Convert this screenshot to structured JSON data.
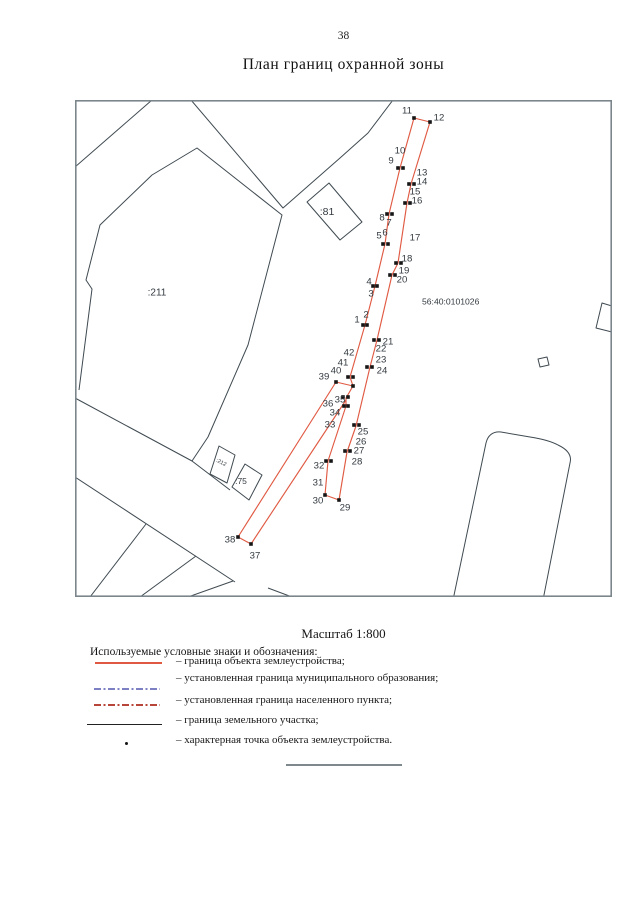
{
  "page": {
    "number": "38",
    "title": "План границ охранной зоны",
    "scale_label": "Масштаб 1:800"
  },
  "colors": {
    "object_boundary": "#e05a43",
    "municipal_boundary": "#7d81c3",
    "settlement_boundary": "#b8453a",
    "parcel_line": "#3f4a51",
    "frame": "#7b868c",
    "point_dot": "#161616",
    "map_text": "#333a40"
  },
  "map": {
    "frame": [
      75,
      100,
      537,
      497
    ],
    "quarter_label": {
      "text": "56:40:0101026",
      "x": 422,
      "y": 298
    },
    "parcel_labels": [
      {
        "text": ":211",
        "x": 157,
        "y": 293,
        "size": 10
      },
      {
        "text": ":81",
        "x": 327,
        "y": 212,
        "size": 10.5
      },
      {
        "text": ":75",
        "x": 241,
        "y": 481,
        "size": 8.5
      },
      {
        "text": ":212",
        "x": 221,
        "y": 463,
        "size": 5.5,
        "rotate": 27
      }
    ],
    "black_polylines": [
      [
        [
          152,
          100
        ],
        [
          75,
          167
        ]
      ],
      [
        [
          191,
          100
        ],
        [
          283,
          208
        ],
        [
          340,
          158
        ],
        [
          368,
          133
        ],
        [
          393,
          100
        ]
      ],
      [
        [
          79,
          390
        ],
        [
          92,
          289
        ],
        [
          86,
          280
        ],
        [
          100,
          225
        ],
        [
          152,
          175
        ],
        [
          197,
          148
        ],
        [
          282,
          215
        ],
        [
          248,
          345
        ],
        [
          208,
          437
        ],
        [
          192,
          461
        ]
      ],
      [
        [
          75,
          398
        ],
        [
          192,
          461
        ],
        [
          230,
          490
        ]
      ],
      [
        [
          75,
          477
        ],
        [
          235,
          582
        ]
      ],
      [
        [
          90,
          597
        ],
        [
          146,
          524
        ]
      ],
      [
        [
          140,
          597
        ],
        [
          196,
          556
        ]
      ],
      [
        [
          188,
          597
        ],
        [
          233,
          581
        ]
      ],
      [
        [
          268,
          588
        ],
        [
          292,
          597
        ]
      ],
      [
        [
          612,
          306
        ],
        [
          602,
          303
        ],
        [
          596,
          328
        ],
        [
          612,
          332
        ]
      ]
    ],
    "black_polygons": [
      [
        [
          329,
          183
        ],
        [
          362,
          222
        ],
        [
          340,
          240
        ],
        [
          307,
          202
        ]
      ],
      [
        [
          219,
          446
        ],
        [
          235,
          455
        ],
        [
          227,
          483
        ],
        [
          210,
          474
        ]
      ],
      [
        [
          245,
          464
        ],
        [
          262,
          475
        ],
        [
          249,
          500
        ],
        [
          232,
          487
        ]
      ],
      [
        [
          538,
          359
        ],
        [
          547,
          357
        ],
        [
          549,
          365
        ],
        [
          540,
          367
        ]
      ]
    ],
    "rounded_shape_path": "M 453 600 L 486 443 Q 489 431 501 432 L 530 437 Q 549 440 558 445 Q 573 452 570 463 L 543 600",
    "red_polylines": [
      [
        [
          414,
          118
        ],
        [
          430,
          122
        ],
        [
          411,
          184
        ],
        [
          407,
          203
        ],
        [
          398,
          263
        ],
        [
          392,
          275
        ],
        [
          377,
          340
        ],
        [
          370,
          367
        ],
        [
          356,
          426
        ],
        [
          347,
          452
        ],
        [
          339,
          500
        ],
        [
          325,
          495
        ],
        [
          328,
          461
        ],
        [
          346,
          406
        ],
        [
          346,
          398
        ],
        [
          353,
          386
        ],
        [
          350,
          377
        ],
        [
          365,
          325
        ],
        [
          375,
          286
        ],
        [
          385,
          244
        ],
        [
          389,
          214
        ],
        [
          400,
          168
        ],
        [
          414,
          118
        ]
      ],
      [
        [
          353,
          386
        ],
        [
          336,
          382
        ],
        [
          238,
          537
        ],
        [
          251,
          544
        ],
        [
          346,
          400
        ]
      ]
    ],
    "dots": [
      [
        414,
        118
      ],
      [
        430,
        122
      ],
      [
        398,
        168
      ],
      [
        403,
        168
      ],
      [
        409,
        184
      ],
      [
        414,
        184
      ],
      [
        405,
        203
      ],
      [
        410,
        203
      ],
      [
        387,
        214
      ],
      [
        392,
        214
      ],
      [
        383,
        244
      ],
      [
        388,
        244
      ],
      [
        396,
        263
      ],
      [
        401,
        263
      ],
      [
        390,
        275
      ],
      [
        395,
        275
      ],
      [
        373,
        286
      ],
      [
        377,
        286
      ],
      [
        363,
        325
      ],
      [
        367,
        325
      ],
      [
        374,
        340
      ],
      [
        379,
        340
      ],
      [
        367,
        367
      ],
      [
        372,
        367
      ],
      [
        348,
        377
      ],
      [
        353,
        377
      ],
      [
        353,
        386
      ],
      [
        336,
        382
      ],
      [
        343,
        397
      ],
      [
        348,
        397
      ],
      [
        344,
        406
      ],
      [
        348,
        406
      ],
      [
        354,
        425
      ],
      [
        359,
        425
      ],
      [
        345,
        451
      ],
      [
        350,
        451
      ],
      [
        326,
        461
      ],
      [
        331,
        461
      ],
      [
        325,
        495
      ],
      [
        339,
        500
      ],
      [
        238,
        537
      ],
      [
        251,
        544
      ]
    ],
    "point_labels": [
      {
        "n": "11",
        "x": 407,
        "y": 111
      },
      {
        "n": "12",
        "x": 439,
        "y": 118
      },
      {
        "n": "10",
        "x": 400,
        "y": 151
      },
      {
        "n": "9",
        "x": 391,
        "y": 161
      },
      {
        "n": "13",
        "x": 422,
        "y": 173
      },
      {
        "n": "14",
        "x": 422,
        "y": 182
      },
      {
        "n": "15",
        "x": 415,
        "y": 192
      },
      {
        "n": "16",
        "x": 417,
        "y": 201
      },
      {
        "n": "8",
        "x": 382,
        "y": 218
      },
      {
        "n": "7",
        "x": 389,
        "y": 223
      },
      {
        "n": "5",
        "x": 379,
        "y": 236
      },
      {
        "n": "6",
        "x": 385,
        "y": 233
      },
      {
        "n": "17",
        "x": 415,
        "y": 238
      },
      {
        "n": "18",
        "x": 407,
        "y": 259
      },
      {
        "n": "19",
        "x": 404,
        "y": 271
      },
      {
        "n": "20",
        "x": 402,
        "y": 280
      },
      {
        "n": "4",
        "x": 369,
        "y": 282
      },
      {
        "n": "3",
        "x": 371,
        "y": 294
      },
      {
        "n": "1",
        "x": 357,
        "y": 320
      },
      {
        "n": "2",
        "x": 366,
        "y": 315
      },
      {
        "n": "21",
        "x": 388,
        "y": 342
      },
      {
        "n": "22",
        "x": 381,
        "y": 349
      },
      {
        "n": "23",
        "x": 381,
        "y": 360
      },
      {
        "n": "24",
        "x": 382,
        "y": 371
      },
      {
        "n": "42",
        "x": 349,
        "y": 353
      },
      {
        "n": "41",
        "x": 343,
        "y": 363
      },
      {
        "n": "40",
        "x": 336,
        "y": 371
      },
      {
        "n": "39",
        "x": 324,
        "y": 377
      },
      {
        "n": "36",
        "x": 328,
        "y": 404
      },
      {
        "n": "35",
        "x": 340,
        "y": 400
      },
      {
        "n": "34",
        "x": 335,
        "y": 413
      },
      {
        "n": "33",
        "x": 330,
        "y": 425
      },
      {
        "n": "25",
        "x": 363,
        "y": 432
      },
      {
        "n": "26",
        "x": 361,
        "y": 442
      },
      {
        "n": "27",
        "x": 359,
        "y": 451
      },
      {
        "n": "28",
        "x": 357,
        "y": 462
      },
      {
        "n": "32",
        "x": 319,
        "y": 466
      },
      {
        "n": "31",
        "x": 318,
        "y": 483
      },
      {
        "n": "30",
        "x": 318,
        "y": 501
      },
      {
        "n": "29",
        "x": 345,
        "y": 508
      },
      {
        "n": "38",
        "x": 230,
        "y": 540
      },
      {
        "n": "37",
        "x": 255,
        "y": 556
      }
    ]
  },
  "legend": {
    "title": "Используемые условные знаки и обозначения:",
    "items": [
      {
        "name": "object-boundary",
        "label": "– граница объекта землеустройства;"
      },
      {
        "name": "municipal-boundary",
        "label": "– установленная граница муниципального образования;"
      },
      {
        "name": "settlement-boundary",
        "label": "– установленная граница населенного пункта;"
      },
      {
        "name": "parcel-boundary",
        "label": "– граница земельного участка;"
      },
      {
        "name": "characteristic-point",
        "label": "– характерная точка объекта землеустройства."
      }
    ]
  }
}
